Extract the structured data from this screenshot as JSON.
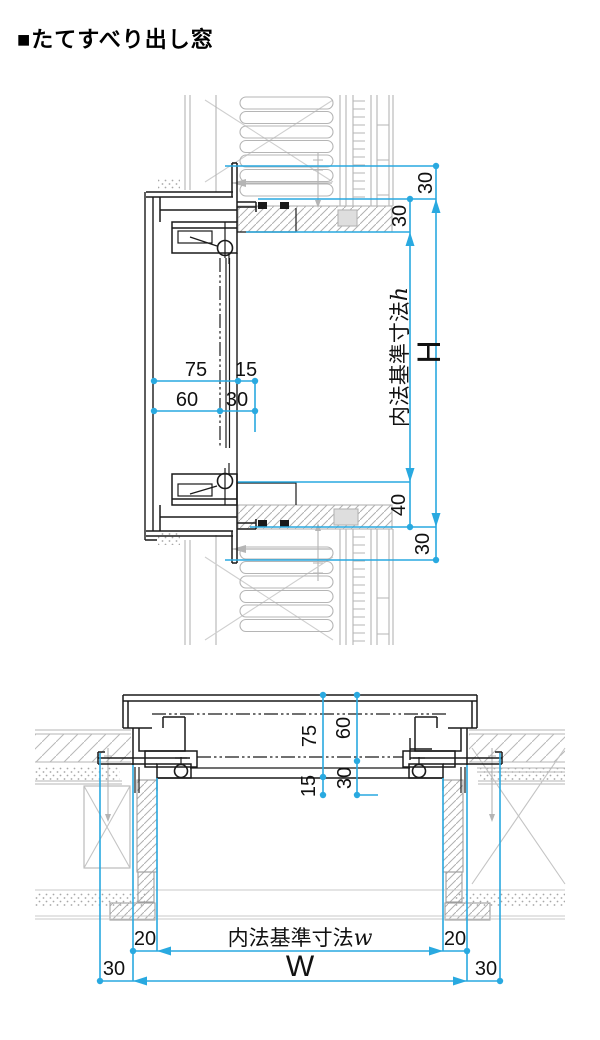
{
  "title": "■たてすべり出し窓",
  "colors": {
    "dimension": "#29a9e0",
    "line": "#1a1a1a",
    "wall": "#b5b5b5"
  },
  "vertical_section": {
    "offset_top": "30",
    "frame_offset": "30",
    "inner_label": "内法基準寸法",
    "inner_var": "h",
    "overall_label": "H",
    "sill_height": "40",
    "offset_bottom": "30",
    "depth_75": "75",
    "depth_15": "15",
    "depth_60": "60",
    "depth_30": "30"
  },
  "horizontal_section": {
    "depth_75": "75",
    "depth_60": "60",
    "depth_15": "15",
    "depth_30": "30",
    "gap_left": "20",
    "gap_right": "20",
    "inner_label": "内法基準寸法",
    "inner_var": "w",
    "overall_label": "W",
    "offset_left": "30",
    "offset_right": "30"
  }
}
